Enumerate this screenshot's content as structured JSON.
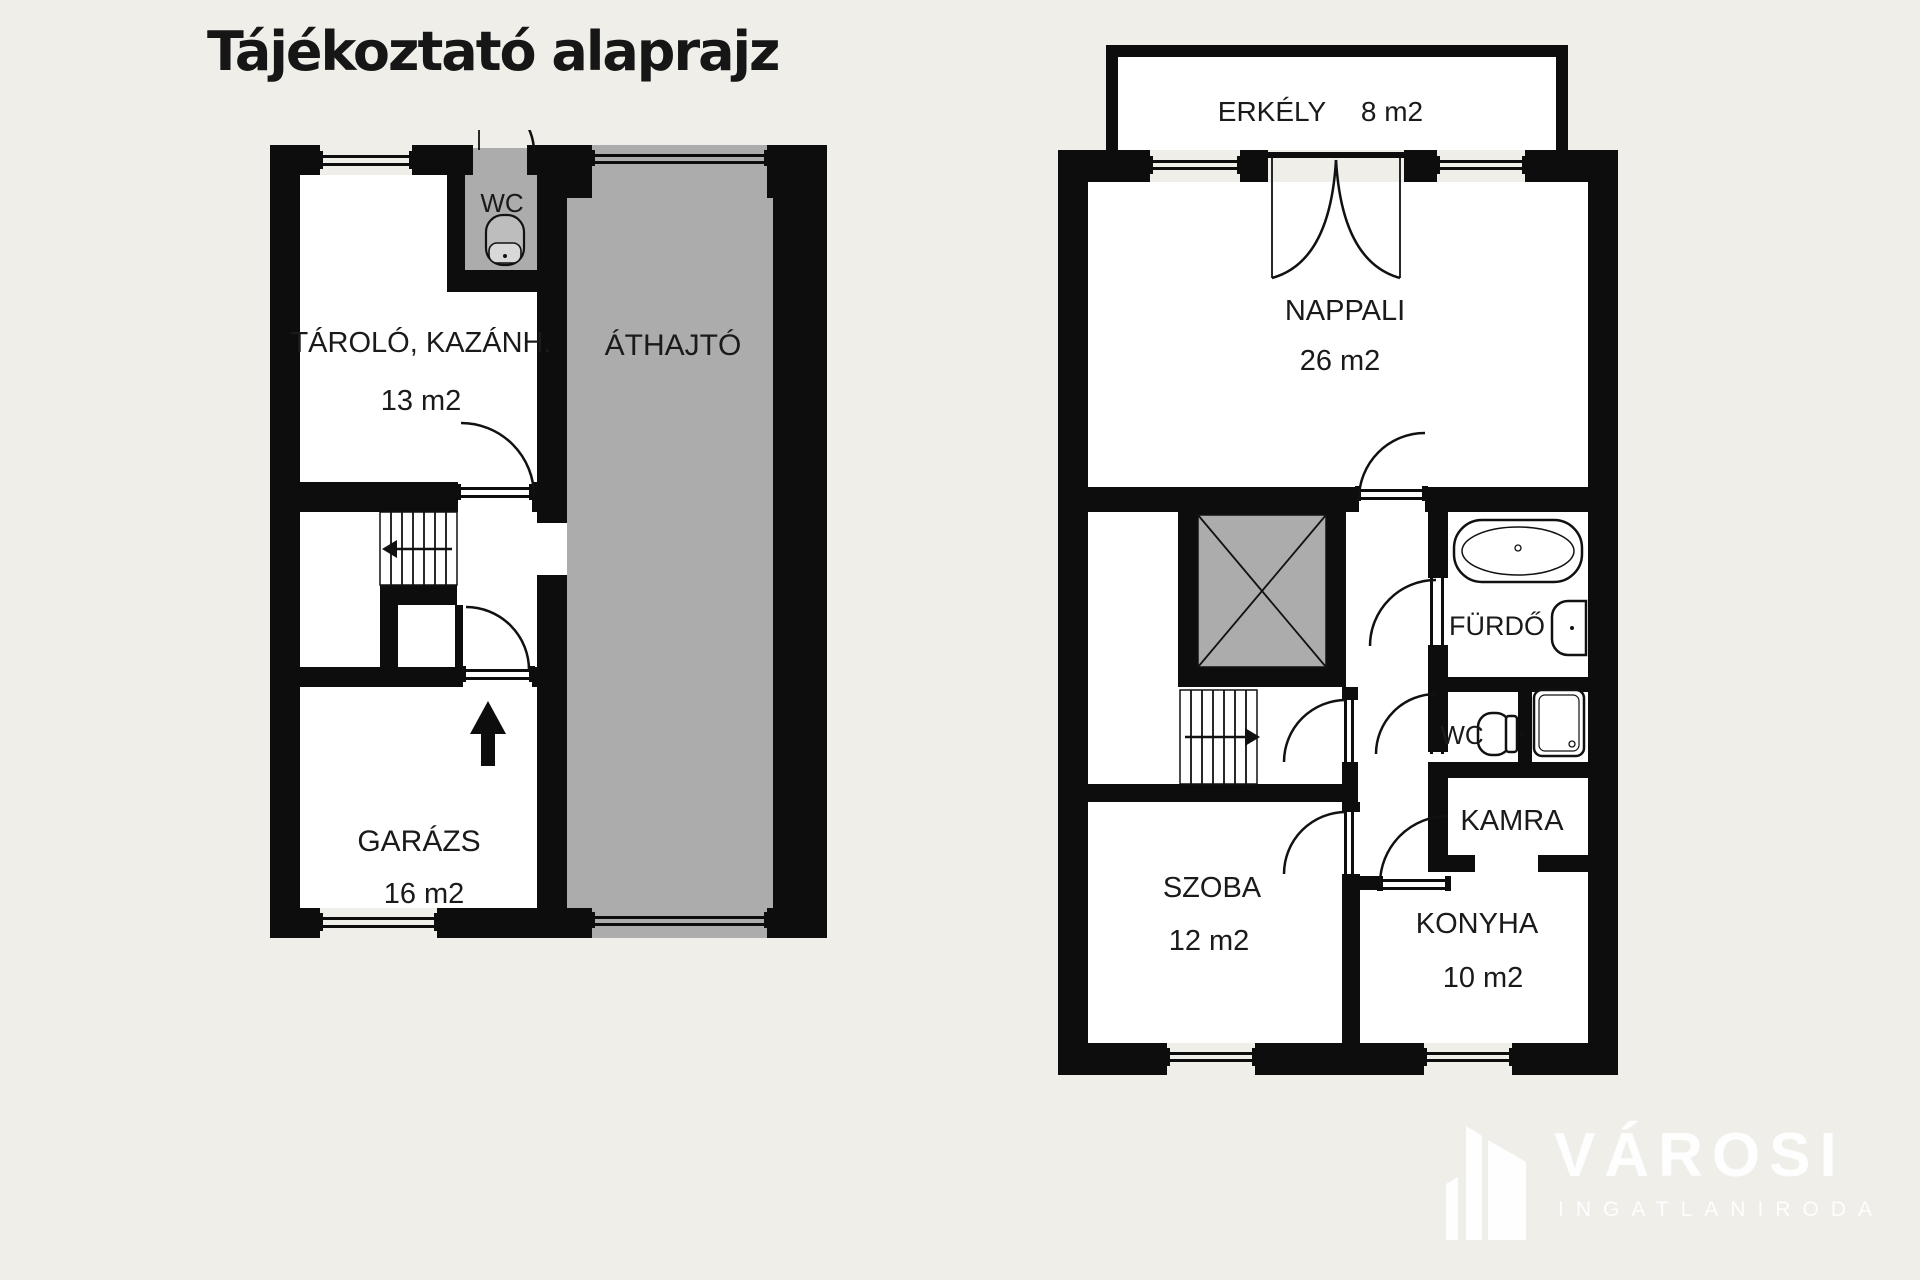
{
  "title": "Tájékoztató alaprajz",
  "colors": {
    "background": "#f0eee9",
    "wall": "#0d0d0d",
    "gray_floor": "#acacac",
    "room_floor": "#ffffff",
    "label": "#1a1a1a",
    "watermark": "#ffffff"
  },
  "ground_floor": {
    "rooms": {
      "wc": {
        "label": "WC"
      },
      "tarolo": {
        "label": "TÁROLÓ, KAZÁNH.",
        "area": "13 m2"
      },
      "athajto": {
        "label": "ÁTHAJTÓ"
      },
      "garazs": {
        "label": "GARÁZS",
        "area": "16 m2"
      }
    }
  },
  "upper_floor": {
    "rooms": {
      "erkely": {
        "label": "ERKÉLY",
        "area": "8 m2"
      },
      "nappali": {
        "label": "NAPPALI",
        "area": "26 m2"
      },
      "furdo": {
        "label": "FÜRDŐ"
      },
      "wc": {
        "label": "WC"
      },
      "kamra": {
        "label": "KAMRA"
      },
      "szoba": {
        "label": "SZOBA",
        "area": "12 m2"
      },
      "konyha": {
        "label": "KONYHA",
        "area": "10 m2"
      }
    }
  },
  "watermark": {
    "brand": "VÁROSI",
    "subtitle": "INGATLANIRODA"
  }
}
